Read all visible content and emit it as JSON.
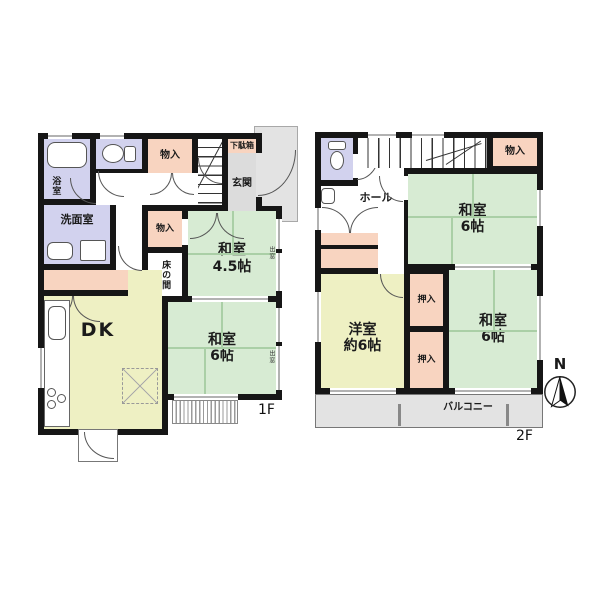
{
  "floor1": {
    "label": "1F",
    "rooms": {
      "bath": "浴室",
      "storage_top": "物入",
      "shoe_cabinet": "下駄箱",
      "entrance": "玄関",
      "washroom": "洗面室",
      "storage_mid": "物入",
      "tokonoma": "床の間",
      "washitsu45": {
        "line1": "和室",
        "line2": "4.5帖"
      },
      "dk": "DK",
      "washitsu6": {
        "line1": "和室",
        "line2": "6帖"
      },
      "bay_window_a": "出窓",
      "bay_window_b": "出窓"
    }
  },
  "floor2": {
    "label": "2F",
    "rooms": {
      "hall": "ホール",
      "storage": "物入",
      "washitsu6_upper": {
        "line1": "和室",
        "line2": "6帖"
      },
      "oshiire_upper": "押入",
      "oshiire_lower": "押入",
      "yoshitsu": {
        "line1": "洋室",
        "line2": "約6帖"
      },
      "washitsu6_lower": {
        "line1": "和室",
        "line2": "6帖"
      },
      "balcony": "バルコニー"
    }
  },
  "compass": {
    "label": "N"
  },
  "colors": {
    "tatami_room": "#d7ebd3",
    "western_room": "#eef0c3",
    "closet": "#f8d4c0",
    "wet_area": "#d2d2ee",
    "entrance_gray": "#dcdcdc",
    "wall": "#161616"
  }
}
